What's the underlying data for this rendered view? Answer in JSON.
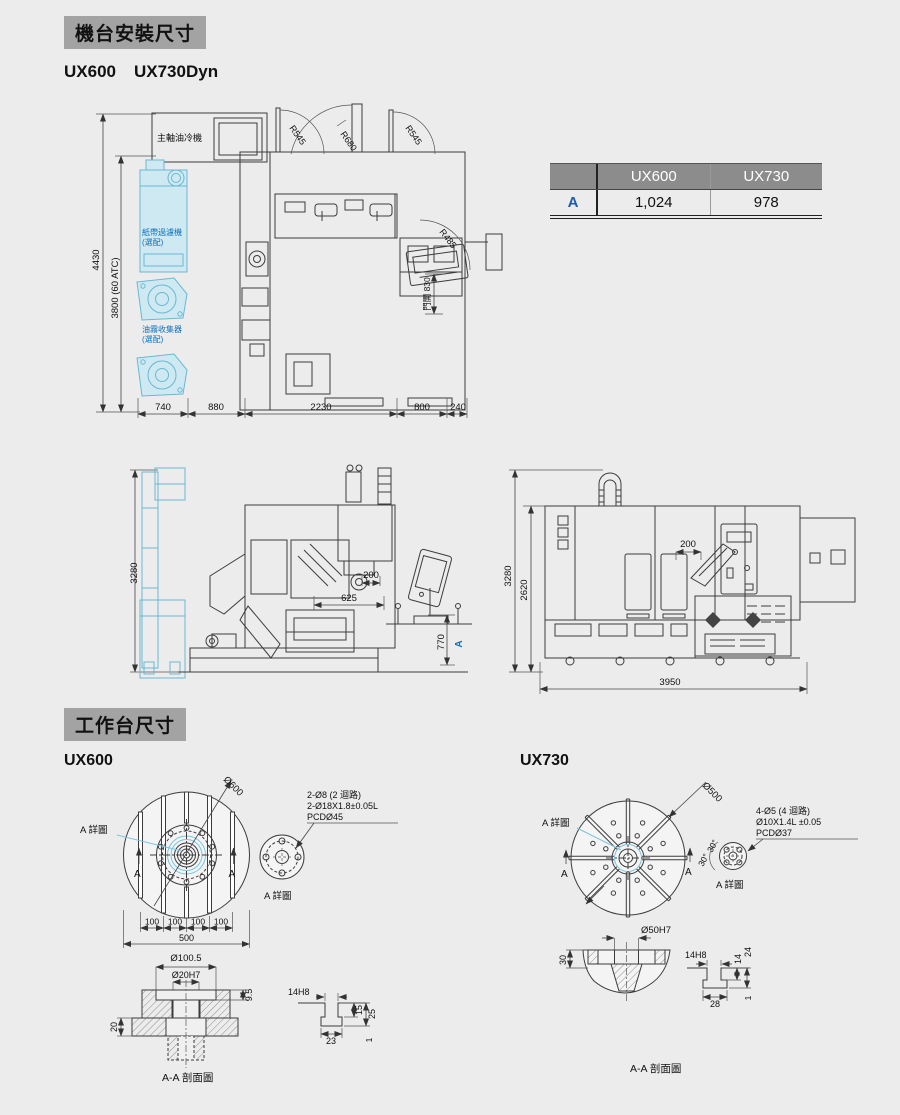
{
  "install": {
    "title": "機台安裝尺寸",
    "model1": "UX600",
    "model2": "UX730Dyn"
  },
  "spec_table": {
    "col1": "UX600",
    "col2": "UX730",
    "row_label": "A",
    "val1": "1,024",
    "val2": "978"
  },
  "top_view": {
    "spindle_cooler": "主軸油冷機",
    "paper_filter": "紙帶過濾機",
    "paper_filter_opt": "(選配)",
    "oil_mist": "油霧收集器",
    "oil_mist_opt": "(選配)",
    "r_door_left": "R545",
    "r_door_mid": "R680",
    "r_door_right": "R545",
    "r_panel": "R485",
    "door_open": "門開 830",
    "dim_height_total": "4430",
    "dim_height_atc": "3800 (60 ATC)",
    "dim_740": "740",
    "dim_880": "880",
    "dim_2230": "2230",
    "dim_800": "800",
    "dim_240": "240"
  },
  "side_view": {
    "dim_3280": "3280",
    "dim_200": "200",
    "dim_625": "625",
    "dim_770": "770",
    "label_a": "A"
  },
  "front_view": {
    "dim_3280": "3280",
    "dim_2620": "2620",
    "dim_200": "200",
    "dim_3950": "3950"
  },
  "worktable": {
    "title": "工作台尺寸"
  },
  "ux600": {
    "label": "UX600",
    "dia": "Ø600",
    "detail_ref": "A 詳圖",
    "sec_left": "A",
    "sec_right": "A",
    "slot_dims": [
      "100",
      "100",
      "100",
      "100"
    ],
    "dim_500": "500",
    "callout1": "2-Ø8 (2 迴路)",
    "callout2": "2-Ø18X1.8±0.05L",
    "callout3": "PCDØ45",
    "detail_caption": "A 詳圖",
    "dia_counterbore": "Ø100.5",
    "dia_bore": "Ø20H7",
    "dim_depth": "9.5",
    "dim_20": "20",
    "tslot_width": "14H8",
    "tslot_d1": "15",
    "tslot_d2": "25",
    "tslot_bottom": "23",
    "tslot_land": "1",
    "section_caption": "A-A 剖面圖"
  },
  "ux730": {
    "label": "UX730",
    "dia": "Ø500",
    "detail_ref": "A 詳圖",
    "sec_left": "A",
    "sec_right": "A",
    "angle1": "30°",
    "angle2": "30°",
    "callout1": "4-Ø5 (4 迴路)",
    "callout2": "Ø10X1.4L ±0.05",
    "callout3": "PCDØ37",
    "detail_caption": "A 詳圖",
    "dia_bore": "Ø50H7",
    "dim_30": "30",
    "tslot_width": "14H8",
    "tslot_d1": "14",
    "tslot_d2": "24",
    "tslot_bottom": "28",
    "tslot_land": "1",
    "section_caption": "A-A 剖面圖"
  }
}
